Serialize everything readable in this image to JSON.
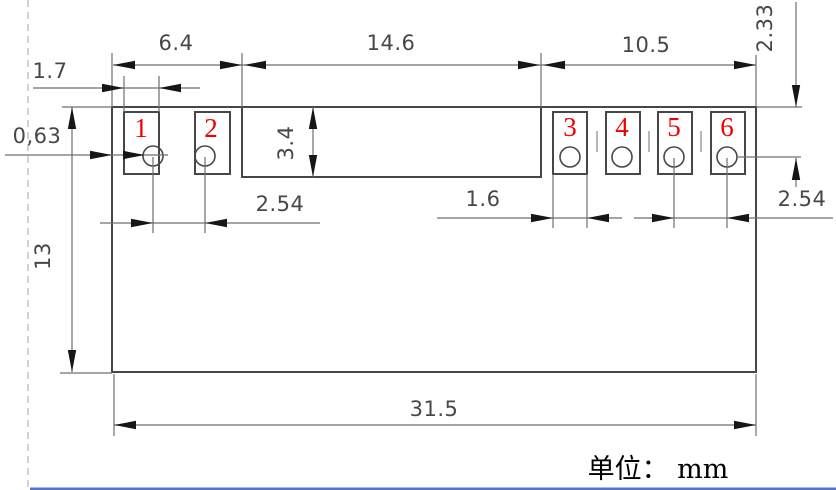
{
  "drawing": {
    "unit_label": "单位： mm",
    "pad_numbers": [
      "1",
      "2",
      "3",
      "4",
      "5",
      "6"
    ],
    "dimensions": {
      "left_section_width": "6.4",
      "middle_section_width": "14.6",
      "right_section_width": "10.5",
      "left_pad_width": "1.7",
      "edge_to_pad1_offset": "0,63",
      "middle_notch_depth": "3.4",
      "pin1_pin2_pitch": "2.54",
      "right_pad_width": "1.6",
      "pin5_pin6_pitch": "2.54",
      "top_edge_to_pin_center": "2.33",
      "body_height": "13",
      "overall_width": "31.5"
    },
    "colors": {
      "outline": "#474747",
      "dimension_line": "#6f6f6f",
      "arrowhead": "#161616",
      "pad_number_red": "#f00000",
      "dashed_line_gray": "#b5b5b5",
      "bottom_bar_blue": "#5170d8"
    }
  }
}
